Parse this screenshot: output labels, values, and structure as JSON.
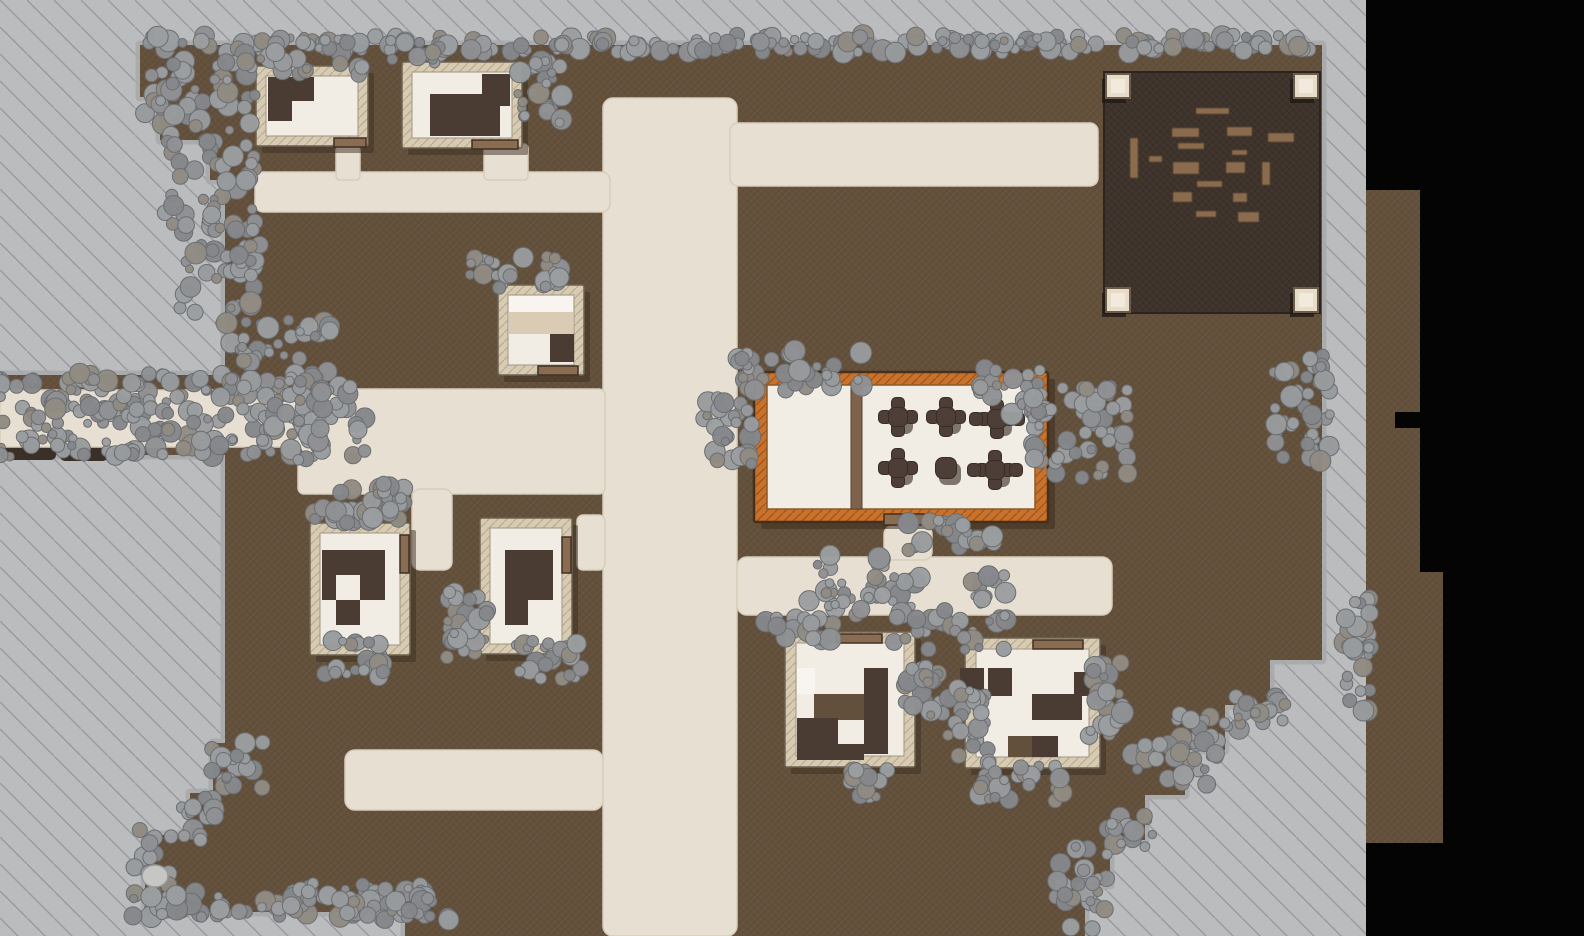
{
  "scene": {
    "width": 1584,
    "height": 936,
    "kind": "top-down-village-battle-map"
  },
  "palette": {
    "void": "#040404",
    "outside_gray": "#bbbcbe",
    "outside_line": "#83848a",
    "ground_brown": "#63503c",
    "ground_dark_spot": "#3a3028",
    "path_cream": "#e7dfd2",
    "path_edge": "#d8cdbb",
    "wall_tan": "#d8cbb4",
    "wall_outline": "#6e6252",
    "floor_cream": "#f1ece4",
    "floor_edge": "#a09480",
    "furniture_dark": "#4a3b33",
    "furniture_light": "#f8f5f0",
    "furniture_mid": "#63503c",
    "furniture_tan": "#d9cbb4",
    "door_wood": "#8a6c50",
    "door_edge": "#3f2f23",
    "shadow": "#3c2e1f",
    "tavern_orange": "#c8722c",
    "tavern_outline": "#46301c",
    "divider_wood": "#7d634c",
    "table_dark": "#4e3e38",
    "table_edge": "#392b26",
    "plaza_dark": "#3f342c",
    "plaza_edge": "#2c241e",
    "plank_wood": "#8a6b4e",
    "plank_edge": "#5c4733",
    "post_cream": "#e6dcc8",
    "post_inner": "#f2ebdd",
    "post_edge": "#6d5b4b",
    "post_shadow": "#201a15",
    "fringe_gray": "#a7a9ab",
    "bush_palette": [
      "#8f9194",
      "#989b9d",
      "#85878a",
      "#9b9ea0",
      "#918b82"
    ],
    "bush_edge": "#6b6e71",
    "rock_fill": "#c6c6c4",
    "rock_edge": "#999a98"
  },
  "outside": {
    "x": 0,
    "y": 0,
    "w": 1366,
    "h": 936
  },
  "ground_polygon": [
    [
      140,
      45
    ],
    [
      140,
      97
    ],
    [
      160,
      97
    ],
    [
      160,
      140
    ],
    [
      210,
      140
    ],
    [
      210,
      180
    ],
    [
      225,
      180
    ],
    [
      225,
      375
    ],
    [
      0,
      375
    ],
    [
      0,
      455
    ],
    [
      225,
      455
    ],
    [
      225,
      743
    ],
    [
      213,
      743
    ],
    [
      213,
      793
    ],
    [
      190,
      793
    ],
    [
      190,
      835
    ],
    [
      145,
      835
    ],
    [
      145,
      912
    ],
    [
      405,
      912
    ],
    [
      405,
      936
    ],
    [
      1085,
      936
    ],
    [
      1085,
      885
    ],
    [
      1110,
      885
    ],
    [
      1110,
      840
    ],
    [
      1145,
      840
    ],
    [
      1145,
      795
    ],
    [
      1185,
      795
    ],
    [
      1185,
      750
    ],
    [
      1225,
      750
    ],
    [
      1225,
      705
    ],
    [
      1270,
      705
    ],
    [
      1270,
      660
    ],
    [
      1322,
      660
    ],
    [
      1322,
      45
    ]
  ],
  "right_strip": [
    {
      "x": 1366,
      "y": 190,
      "w": 54,
      "h": 382
    },
    {
      "x": 1366,
      "y": 572,
      "w": 77,
      "h": 271
    }
  ],
  "right_strip_notch": {
    "x": 1395,
    "y": 412,
    "w": 25,
    "h": 16
  },
  "dark_spots": [
    {
      "x": 0,
      "y": 440,
      "w": 56,
      "h": 20
    },
    {
      "x": 60,
      "y": 447,
      "w": 48,
      "h": 14
    },
    {
      "x": 112,
      "y": 450,
      "w": 22,
      "h": 10
    },
    {
      "x": 305,
      "y": 447,
      "w": 52,
      "h": 14
    }
  ],
  "paths": [
    {
      "name": "main-road",
      "x": 603,
      "y": 98,
      "w": 134,
      "h": 838,
      "r": 10
    },
    {
      "name": "north-road",
      "x": 730,
      "y": 123,
      "w": 368,
      "h": 63,
      "r": 8
    },
    {
      "name": "northwest-lane",
      "x": 255,
      "y": 172,
      "w": 355,
      "h": 40,
      "r": 8
    },
    {
      "name": "house-a-stub",
      "x": 336,
      "y": 146,
      "w": 24,
      "h": 34,
      "r": 4
    },
    {
      "name": "house-b-stub",
      "x": 484,
      "y": 144,
      "w": 44,
      "h": 36,
      "r": 4
    },
    {
      "name": "west-corridor",
      "x": 0,
      "y": 390,
      "w": 312,
      "h": 57,
      "r": 0
    },
    {
      "name": "west-plaza",
      "x": 298,
      "y": 389,
      "w": 307,
      "h": 105,
      "r": 6
    },
    {
      "name": "between-houses-lane",
      "x": 412,
      "y": 489,
      "w": 40,
      "h": 81,
      "r": 8
    },
    {
      "name": "house-e-stub",
      "x": 577,
      "y": 515,
      "w": 28,
      "h": 55,
      "r": 6
    },
    {
      "name": "east-road",
      "x": 737,
      "y": 557,
      "w": 375,
      "h": 58,
      "r": 10
    },
    {
      "name": "tavern-stoop",
      "x": 884,
      "y": 526,
      "w": 48,
      "h": 34,
      "r": 8
    },
    {
      "name": "southwest-road",
      "x": 345,
      "y": 750,
      "w": 258,
      "h": 60,
      "r": 10
    }
  ],
  "buildings": [
    {
      "name": "house-a",
      "x": 256,
      "y": 66,
      "w": 112,
      "h": 80,
      "wall": 10,
      "door": {
        "x": 334,
        "y": 138,
        "w": 32,
        "h": 9
      },
      "furniture": [
        {
          "x": 268,
          "y": 77,
          "w": 46,
          "h": 24,
          "tone": "dark"
        },
        {
          "x": 268,
          "y": 101,
          "w": 24,
          "h": 20,
          "tone": "dark"
        }
      ]
    },
    {
      "name": "house-b",
      "x": 402,
      "y": 62,
      "w": 120,
      "h": 86,
      "wall": 10,
      "door": {
        "x": 472,
        "y": 140,
        "w": 46,
        "h": 9
      },
      "furniture": [
        {
          "x": 430,
          "y": 94,
          "w": 70,
          "h": 42,
          "tone": "dark"
        },
        {
          "x": 482,
          "y": 74,
          "w": 28,
          "h": 32,
          "tone": "dark"
        }
      ]
    },
    {
      "name": "house-c",
      "x": 498,
      "y": 285,
      "w": 86,
      "h": 90,
      "wall": 10,
      "door": {
        "x": 538,
        "y": 366,
        "w": 40,
        "h": 9
      },
      "furniture": [
        {
          "x": 509,
          "y": 296,
          "w": 64,
          "h": 16,
          "tone": "light"
        },
        {
          "x": 509,
          "y": 312,
          "w": 64,
          "h": 22,
          "tone": "tan"
        },
        {
          "x": 550,
          "y": 334,
          "w": 24,
          "h": 28,
          "tone": "dark"
        }
      ]
    },
    {
      "name": "house-d",
      "x": 310,
      "y": 523,
      "w": 100,
      "h": 132,
      "wall": 10,
      "door": {
        "x": 400,
        "y": 535,
        "w": 9,
        "h": 38
      },
      "furniture": [
        {
          "x": 322,
          "y": 550,
          "w": 63,
          "h": 50,
          "tone": "dark"
        },
        {
          "x": 336,
          "y": 575,
          "w": 24,
          "h": 25,
          "tone": "floor"
        },
        {
          "x": 336,
          "y": 600,
          "w": 24,
          "h": 25,
          "tone": "dark"
        }
      ]
    },
    {
      "name": "house-e",
      "x": 480,
      "y": 518,
      "w": 92,
      "h": 136,
      "wall": 10,
      "door": {
        "x": 562,
        "y": 537,
        "w": 9,
        "h": 36
      },
      "furniture": [
        {
          "x": 505,
          "y": 550,
          "w": 48,
          "h": 50,
          "tone": "dark"
        },
        {
          "x": 505,
          "y": 600,
          "w": 23,
          "h": 25,
          "tone": "dark"
        }
      ]
    },
    {
      "name": "house-f",
      "x": 785,
      "y": 632,
      "w": 130,
      "h": 135,
      "wall": 11,
      "door": {
        "x": 836,
        "y": 634,
        "w": 46,
        "h": 9
      },
      "furniture": [
        {
          "x": 797,
          "y": 668,
          "w": 18,
          "h": 26,
          "tone": "light"
        },
        {
          "x": 814,
          "y": 694,
          "w": 50,
          "h": 26,
          "tone": "mid"
        },
        {
          "x": 864,
          "y": 668,
          "w": 24,
          "h": 86,
          "tone": "dark"
        },
        {
          "x": 797,
          "y": 718,
          "w": 41,
          "h": 42,
          "tone": "dark"
        },
        {
          "x": 838,
          "y": 744,
          "w": 26,
          "h": 16,
          "tone": "dark"
        }
      ]
    },
    {
      "name": "house-g",
      "x": 965,
      "y": 638,
      "w": 135,
      "h": 130,
      "wall": 11,
      "door": {
        "x": 1033,
        "y": 640,
        "w": 50,
        "h": 9
      },
      "furniture": [
        {
          "x": 960,
          "y": 668,
          "w": 24,
          "h": 28,
          "tone": "dark"
        },
        {
          "x": 988,
          "y": 668,
          "w": 24,
          "h": 28,
          "tone": "dark"
        },
        {
          "x": 1032,
          "y": 694,
          "w": 50,
          "h": 26,
          "tone": "dark"
        },
        {
          "x": 1074,
          "y": 672,
          "w": 22,
          "h": 24,
          "tone": "dark"
        },
        {
          "x": 1008,
          "y": 736,
          "w": 24,
          "h": 21,
          "tone": "mid"
        },
        {
          "x": 1032,
          "y": 736,
          "w": 26,
          "h": 21,
          "tone": "dark"
        }
      ]
    }
  ],
  "tavern": {
    "name": "tavern",
    "x": 754,
    "y": 372,
    "w": 294,
    "h": 150,
    "wall": 13,
    "door": {
      "x": 884,
      "y": 514,
      "w": 48,
      "h": 11
    },
    "divider": {
      "x": 851,
      "y": 385,
      "w": 11,
      "h": 124
    },
    "tables": [
      {
        "x": 898,
        "y": 417,
        "kind": "four"
      },
      {
        "x": 946,
        "y": 417,
        "kind": "four"
      },
      {
        "x": 997,
        "y": 419,
        "kind": "six"
      },
      {
        "x": 898,
        "y": 468,
        "kind": "four"
      },
      {
        "x": 946,
        "y": 468,
        "kind": "plain"
      },
      {
        "x": 995,
        "y": 470,
        "kind": "six"
      }
    ]
  },
  "plaza": {
    "x": 1104,
    "y": 72,
    "w": 216,
    "h": 241,
    "post_size": 24,
    "posts": [
      {
        "x": 1106,
        "y": 74
      },
      {
        "x": 1294,
        "y": 74
      },
      {
        "x": 1106,
        "y": 288
      },
      {
        "x": 1294,
        "y": 288
      }
    ],
    "planks": [
      [
        1196,
        108,
        33,
        6
      ],
      [
        1172,
        128,
        27,
        9
      ],
      [
        1227,
        127,
        25,
        9
      ],
      [
        1268,
        133,
        26,
        9
      ],
      [
        1178,
        143,
        26,
        6
      ],
      [
        1232,
        150,
        15,
        5
      ],
      [
        1130,
        138,
        8,
        40
      ],
      [
        1149,
        156,
        13,
        6
      ],
      [
        1173,
        162,
        26,
        12
      ],
      [
        1226,
        162,
        19,
        11
      ],
      [
        1262,
        162,
        8,
        23
      ],
      [
        1197,
        181,
        25,
        6
      ],
      [
        1173,
        192,
        19,
        10
      ],
      [
        1233,
        193,
        14,
        9
      ],
      [
        1196,
        211,
        20,
        6
      ],
      [
        1238,
        212,
        21,
        10
      ]
    ]
  },
  "bushes": [
    {
      "name": "tree-line-north",
      "x": 729,
      "y": 44,
      "rx": 580,
      "ry": 9,
      "n": 190,
      "seed": 11
    },
    {
      "name": "grove-house-a",
      "x": 300,
      "y": 57,
      "rx": 62,
      "ry": 18,
      "n": 34,
      "seed": 2
    },
    {
      "name": "grove-house-b-left",
      "x": 420,
      "y": 52,
      "rx": 30,
      "ry": 12,
      "n": 16,
      "seed": 3
    },
    {
      "name": "grove-house-b-right",
      "x": 540,
      "y": 92,
      "rx": 22,
      "ry": 32,
      "n": 26,
      "seed": 4
    },
    {
      "name": "grove-west-edge-1",
      "x": 200,
      "y": 100,
      "rx": 55,
      "ry": 42,
      "n": 48,
      "seed": 5
    },
    {
      "name": "grove-west-edge-2",
      "x": 210,
      "y": 185,
      "rx": 45,
      "ry": 48,
      "n": 46,
      "seed": 6
    },
    {
      "name": "grove-west-edge-3",
      "x": 220,
      "y": 270,
      "rx": 40,
      "ry": 45,
      "n": 42,
      "seed": 7
    },
    {
      "name": "grove-west-edge-4",
      "x": 275,
      "y": 350,
      "rx": 55,
      "ry": 30,
      "n": 38,
      "seed": 8
    },
    {
      "name": "west-corridor-thicket",
      "x": 150,
      "y": 415,
      "rx": 165,
      "ry": 42,
      "n": 200,
      "seed": 9
    },
    {
      "name": "thicket-corridor-east",
      "x": 320,
      "y": 420,
      "rx": 45,
      "ry": 40,
      "n": 48,
      "seed": 10
    },
    {
      "name": "grove-house-c",
      "x": 515,
      "y": 272,
      "rx": 45,
      "ry": 17,
      "n": 26,
      "seed": 12
    },
    {
      "name": "grove-house-d-north",
      "x": 360,
      "y": 505,
      "rx": 45,
      "ry": 20,
      "n": 28,
      "seed": 13
    },
    {
      "name": "grove-house-d-south",
      "x": 358,
      "y": 660,
      "rx": 33,
      "ry": 20,
      "n": 22,
      "seed": 14
    },
    {
      "name": "grove-house-e-west",
      "x": 467,
      "y": 625,
      "rx": 20,
      "ry": 34,
      "n": 26,
      "seed": 15
    },
    {
      "name": "grove-house-e-south",
      "x": 550,
      "y": 660,
      "rx": 34,
      "ry": 19,
      "n": 22,
      "seed": 16
    },
    {
      "name": "grove-tavern-north",
      "x": 800,
      "y": 370,
      "rx": 62,
      "ry": 22,
      "n": 36,
      "seed": 17
    },
    {
      "name": "grove-tavern-west",
      "x": 728,
      "y": 428,
      "rx": 24,
      "ry": 36,
      "n": 26,
      "seed": 18
    },
    {
      "name": "grove-tavern-east-1",
      "x": 1012,
      "y": 392,
      "rx": 32,
      "ry": 24,
      "n": 24,
      "seed": 19
    },
    {
      "name": "grove-tavern-east-2",
      "x": 1080,
      "y": 432,
      "rx": 48,
      "ry": 46,
      "n": 58,
      "seed": 20
    },
    {
      "name": "grove-tavern-south-1",
      "x": 855,
      "y": 585,
      "rx": 46,
      "ry": 30,
      "n": 34,
      "seed": 21
    },
    {
      "name": "grove-tavern-south-2",
      "x": 950,
      "y": 612,
      "rx": 56,
      "ry": 38,
      "n": 44,
      "seed": 22
    },
    {
      "name": "grove-road-east",
      "x": 950,
      "y": 537,
      "rx": 45,
      "ry": 17,
      "n": 22,
      "seed": 23
    },
    {
      "name": "grove-east-edge",
      "x": 1302,
      "y": 410,
      "rx": 28,
      "ry": 55,
      "n": 40,
      "seed": 24
    },
    {
      "name": "grove-house-f-nw",
      "x": 800,
      "y": 628,
      "rx": 34,
      "ry": 15,
      "n": 18,
      "seed": 25
    },
    {
      "name": "grove-house-f-east",
      "x": 925,
      "y": 690,
      "rx": 20,
      "ry": 30,
      "n": 22,
      "seed": 26
    },
    {
      "name": "grove-house-f-south",
      "x": 872,
      "y": 780,
      "rx": 22,
      "ry": 18,
      "n": 15,
      "seed": 27
    },
    {
      "name": "grove-house-g-west",
      "x": 968,
      "y": 722,
      "rx": 20,
      "ry": 36,
      "n": 24,
      "seed": 28
    },
    {
      "name": "grove-house-g-south",
      "x": 1022,
      "y": 782,
      "rx": 42,
      "ry": 20,
      "n": 26,
      "seed": 29
    },
    {
      "name": "grove-house-g-east",
      "x": 1106,
      "y": 700,
      "rx": 17,
      "ry": 40,
      "n": 24,
      "seed": 30
    },
    {
      "name": "grove-se-steps-1",
      "x": 1262,
      "y": 712,
      "rx": 26,
      "ry": 18,
      "n": 16,
      "seed": 31
    },
    {
      "name": "grove-se-steps-2",
      "x": 1205,
      "y": 728,
      "rx": 28,
      "ry": 14,
      "n": 14,
      "seed": 32
    },
    {
      "name": "grove-se-steps-3",
      "x": 1175,
      "y": 762,
      "rx": 42,
      "ry": 24,
      "n": 26,
      "seed": 33
    },
    {
      "name": "grove-se-steps-4",
      "x": 1132,
      "y": 830,
      "rx": 24,
      "ry": 20,
      "n": 16,
      "seed": 34
    },
    {
      "name": "grove-se-steps-5",
      "x": 1082,
      "y": 888,
      "rx": 26,
      "ry": 42,
      "n": 28,
      "seed": 35
    },
    {
      "name": "grove-south-edge",
      "x": 290,
      "y": 900,
      "rx": 140,
      "ry": 17,
      "n": 75,
      "seed": 36
    },
    {
      "name": "grove-south-edge-2",
      "x": 395,
      "y": 907,
      "rx": 55,
      "ry": 13,
      "n": 24,
      "seed": 37
    },
    {
      "name": "grove-sw-edge",
      "x": 155,
      "y": 872,
      "rx": 22,
      "ry": 44,
      "n": 26,
      "seed": 38
    },
    {
      "name": "grove-sw-steps",
      "x": 238,
      "y": 768,
      "rx": 26,
      "ry": 26,
      "n": 18,
      "seed": 39
    },
    {
      "name": "grove-sw-steps-2",
      "x": 200,
      "y": 818,
      "rx": 18,
      "ry": 22,
      "n": 14,
      "seed": 40
    },
    {
      "name": "grove-east-strip",
      "x": 1358,
      "y": 655,
      "rx": 13,
      "ry": 58,
      "n": 28,
      "seed": 41
    },
    {
      "name": "grove-d-corner",
      "x": 388,
      "y": 500,
      "rx": 16,
      "ry": 18,
      "n": 12,
      "seed": 42
    }
  ],
  "rock": {
    "x": 155,
    "y": 876,
    "rx": 13,
    "ry": 11
  }
}
